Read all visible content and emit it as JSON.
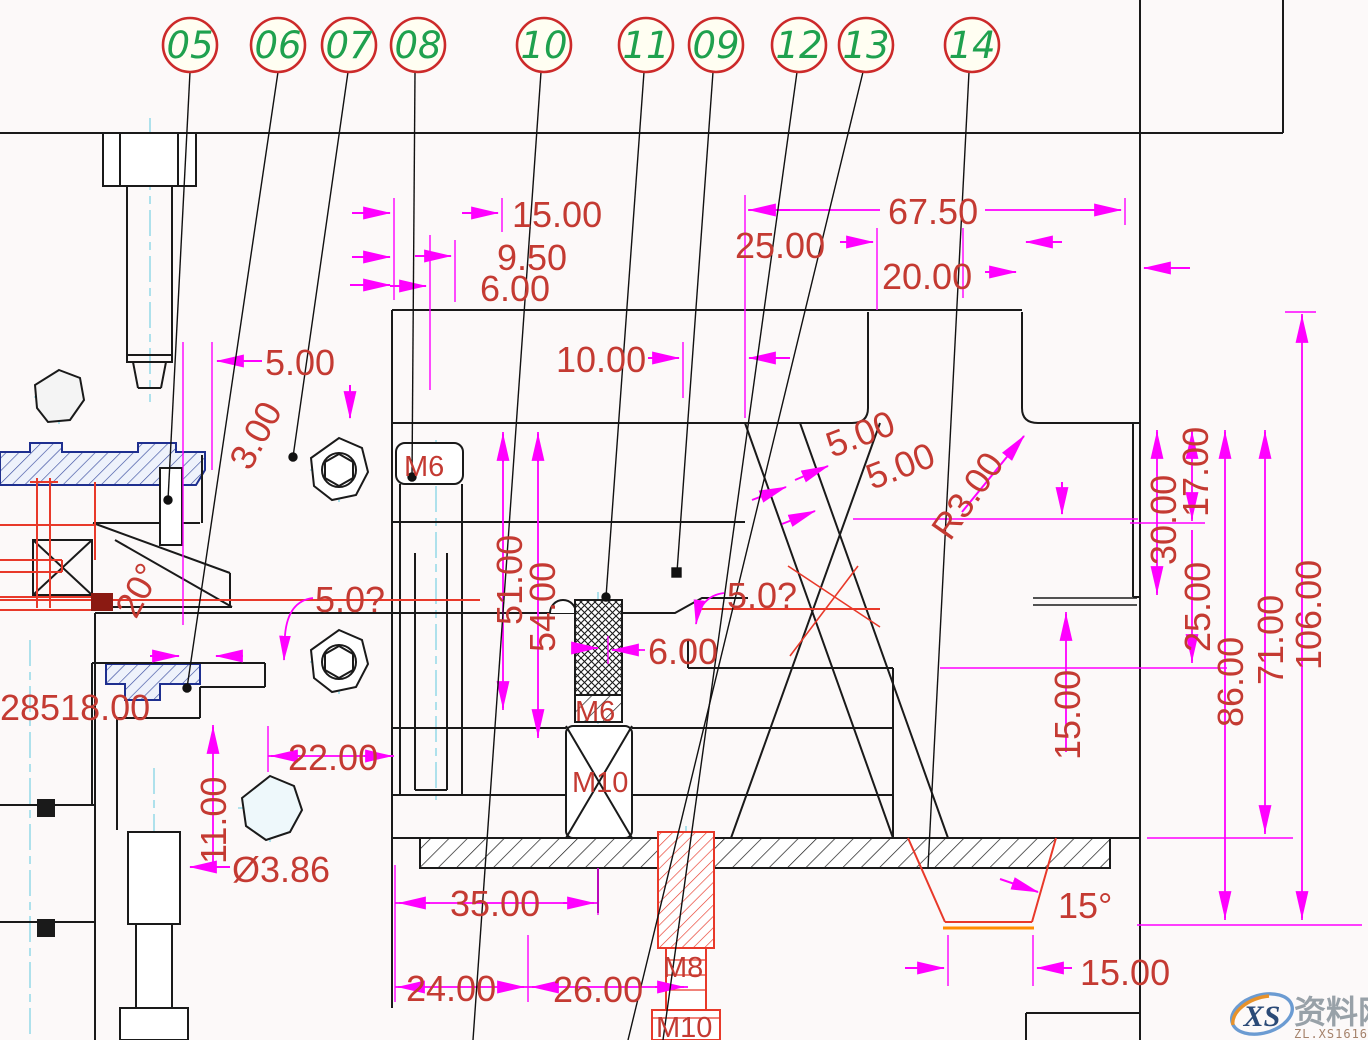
{
  "drawing": {
    "type": "mold-assembly-section-cad-drawing",
    "colors": {
      "dim_text_red": "#c43a32",
      "geometry_red": "#e8392a",
      "dim_line_magenta": "#ff00ff",
      "balloon_circle_red": "#cc2a2a",
      "balloon_number_green": "#1fa14e",
      "centerline_cyan": "#9adbe8",
      "part_hatch_blue": "#3b4ea0",
      "line_black": "#1a1a1a"
    }
  },
  "balloons": [
    {
      "id": "05"
    },
    {
      "id": "06"
    },
    {
      "id": "07"
    },
    {
      "id": "08"
    },
    {
      "id": "10"
    },
    {
      "id": "11"
    },
    {
      "id": "09"
    },
    {
      "id": "12"
    },
    {
      "id": "13"
    },
    {
      "id": "14"
    }
  ],
  "dimensions": {
    "d15_top": "15.00",
    "d9_50": "9.50",
    "d6_top": "6.00",
    "d67_50": "67.50",
    "d25_top": "25.00",
    "d20_top": "20.00",
    "d5_left": "5.00",
    "d8": "8.00",
    "d10": "10.00",
    "d5_a": "5.00",
    "d5_b": "5.00",
    "r3": "R3.00",
    "d3": "3.00",
    "d20deg": "20°",
    "d5q_left": "5.0?",
    "d5q_right": "5.0?",
    "d51": "51.00",
    "d54": "54.00",
    "d6_mid": "6.00",
    "d30": "30.00",
    "d17": "17.00",
    "d25_right": "25.00",
    "d86": "86.00",
    "d71": "71.00",
    "d106": "106.00",
    "d15_right_v": "15.00",
    "d28518": "28518.00",
    "d22": "22.00",
    "d11": "11.00",
    "dia386": "Ø3.86",
    "d35": "35.00",
    "d24": "24.00",
    "d26": "26.00",
    "d15_bot": "15.00",
    "a15deg": "15°"
  },
  "threads": {
    "m6_top": "M6",
    "m6_mid": "M6",
    "m10_mid": "M10",
    "m8": "M8",
    "m10_bot": "M10"
  },
  "watermark": {
    "logo": "XS",
    "name": "资料网",
    "url": "ZL.XS1616.COM"
  }
}
